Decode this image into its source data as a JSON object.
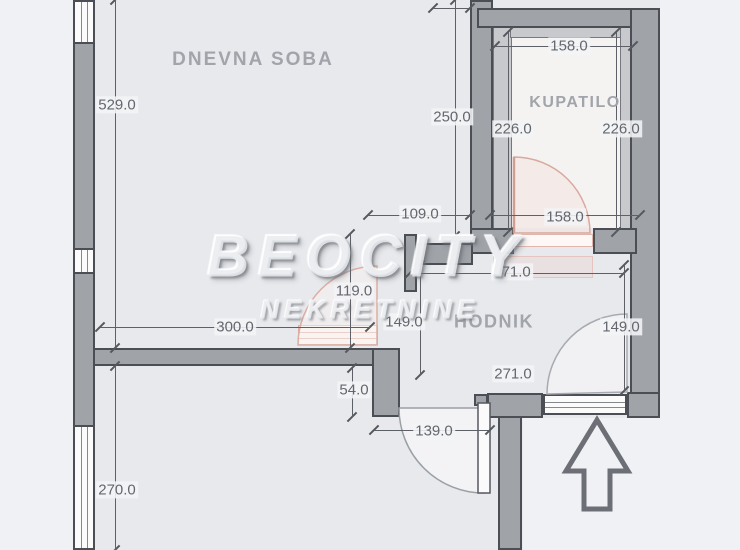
{
  "watermark": {
    "brand": "BEOCITY",
    "subtitle": "NEKRETNINE"
  },
  "rooms": [
    {
      "key": "dnevna-soba",
      "name": "DNEVNA SOBA",
      "x": 253,
      "y": 60
    },
    {
      "key": "kupatilo",
      "name": "KUPATILO",
      "x": 575,
      "y": 103
    },
    {
      "key": "hodnik",
      "name": "HODNIK",
      "x": 494,
      "y": 322
    }
  ],
  "dimensions": [
    {
      "name": "dim-529",
      "label": "529.0",
      "x": 117,
      "y": 105
    },
    {
      "name": "dim-270",
      "label": "270.0",
      "x": 117,
      "y": 490
    },
    {
      "name": "dim-250",
      "label": "250.0",
      "x": 452,
      "y": 117
    },
    {
      "name": "dim-226-left",
      "label": "226.0",
      "x": 513,
      "y": 129
    },
    {
      "name": "dim-226-right",
      "label": "226.0",
      "x": 621,
      "y": 129
    },
    {
      "name": "dim-158-top",
      "label": "158.0",
      "x": 569,
      "y": 46
    },
    {
      "name": "dim-158-bottom",
      "label": "158.0",
      "x": 565,
      "y": 217
    },
    {
      "name": "dim-109",
      "label": "109.0",
      "x": 420,
      "y": 214
    },
    {
      "name": "dim-271-top",
      "label": "271.0",
      "x": 512,
      "y": 272
    },
    {
      "name": "dim-119",
      "label": "119.0",
      "x": 354,
      "y": 291
    },
    {
      "name": "dim-149-left",
      "label": "149.0",
      "x": 404,
      "y": 322
    },
    {
      "name": "dim-149-right",
      "label": "149.0",
      "x": 621,
      "y": 327
    },
    {
      "name": "dim-300",
      "label": "300.0",
      "x": 235,
      "y": 327
    },
    {
      "name": "dim-54",
      "label": "54.0",
      "x": 354,
      "y": 390
    },
    {
      "name": "dim-271-bottom",
      "label": "271.0",
      "x": 513,
      "y": 374
    },
    {
      "name": "dim-139",
      "label": "139.0",
      "x": 434,
      "y": 431
    }
  ],
  "colors": {
    "wall_fill": "#a0a3a8",
    "wall_border": "#4b4e54",
    "lining_fill": "#c7c9cc",
    "window_fill": "#fbfbfc",
    "dimension_text": "#64676d",
    "room_label": "#a1a4aa",
    "door_pink": "#dcaea3",
    "arrow": "#6c6f75",
    "background": "#eff1f5",
    "interior": "#e8e9ec"
  },
  "geometry": {
    "zones": [
      {
        "name": "interior-main",
        "type": "interior",
        "x": 73,
        "y": 0,
        "w": 587,
        "h": 418
      },
      {
        "name": "interior-bottom",
        "type": "interior",
        "x": 73,
        "y": 348,
        "w": 450,
        "h": 202
      },
      {
        "name": "interior-bathroom",
        "type": "bath",
        "x": 512,
        "y": 38,
        "w": 108,
        "h": 190
      }
    ],
    "walls": [
      {
        "name": "left-window-top",
        "type": "window-v",
        "x": 73,
        "y": 0,
        "w": 22,
        "h": 44
      },
      {
        "name": "left-wall-upper",
        "type": "wall",
        "x": 73,
        "y": 42,
        "w": 22,
        "h": 208
      },
      {
        "name": "left-window-middle",
        "type": "window-v",
        "x": 73,
        "y": 248,
        "w": 22,
        "h": 26
      },
      {
        "name": "left-wall-lower",
        "type": "wall",
        "x": 73,
        "y": 272,
        "w": 22,
        "h": 155
      },
      {
        "name": "left-window-bottom",
        "type": "window-v",
        "x": 73,
        "y": 425,
        "w": 22,
        "h": 125
      },
      {
        "name": "center-vertical-wall",
        "type": "wall",
        "x": 470,
        "y": 0,
        "w": 23,
        "h": 244
      },
      {
        "name": "bathroom-top-wall",
        "type": "wall",
        "x": 477,
        "y": 8,
        "w": 183,
        "h": 20
      },
      {
        "name": "right-exterior-wall",
        "type": "wall",
        "x": 630,
        "y": 8,
        "w": 30,
        "h": 410
      },
      {
        "name": "bathroom-lining-left",
        "type": "lining",
        "x": 493,
        "y": 26,
        "w": 19,
        "h": 212
      },
      {
        "name": "bathroom-lining-top",
        "type": "lining",
        "x": 510,
        "y": 26,
        "w": 127,
        "h": 12
      },
      {
        "name": "bathroom-lining-right",
        "type": "lining",
        "x": 620,
        "y": 26,
        "w": 12,
        "h": 212
      },
      {
        "name": "bathroom-bottom-wall-left",
        "type": "wall",
        "x": 470,
        "y": 228,
        "w": 44,
        "h": 26
      },
      {
        "name": "bathroom-bottom-wall-right",
        "type": "wall",
        "x": 593,
        "y": 228,
        "w": 44,
        "h": 26
      },
      {
        "name": "hodnik-left-wall",
        "type": "wall",
        "x": 404,
        "y": 234,
        "w": 13,
        "h": 58
      },
      {
        "name": "hodnik-top-wall",
        "type": "wall",
        "x": 417,
        "y": 243,
        "w": 56,
        "h": 22
      },
      {
        "name": "middle-horizontal-wall",
        "type": "wall",
        "x": 93,
        "y": 348,
        "w": 281,
        "h": 18
      },
      {
        "name": "step-wall",
        "type": "wall",
        "x": 372,
        "y": 348,
        "w": 28,
        "h": 69
      },
      {
        "name": "entry-wall-cap",
        "type": "wall",
        "x": 487,
        "y": 393,
        "w": 56,
        "h": 25
      },
      {
        "name": "bottom-vertical-wall",
        "type": "wall",
        "x": 498,
        "y": 416,
        "w": 24,
        "h": 134
      },
      {
        "name": "entry-window",
        "type": "window-h",
        "x": 543,
        "y": 394,
        "w": 84,
        "h": 21
      },
      {
        "name": "bottom-wall-right-block",
        "type": "wall",
        "x": 627,
        "y": 392,
        "w": 33,
        "h": 26
      },
      {
        "name": "entry-door-hinge-block",
        "type": "wall",
        "x": 474,
        "y": 394,
        "w": 14,
        "h": 12
      },
      {
        "name": "bathroom-door-threshold",
        "type": "threshold",
        "x": 514,
        "y": 234,
        "w": 79,
        "h": 13
      },
      {
        "name": "renovation-pink-zone",
        "type": "pinkzone",
        "x": 493,
        "y": 256,
        "w": 100,
        "h": 22
      },
      {
        "name": "living-door-pocket",
        "type": "pocket",
        "x": 298,
        "y": 325,
        "w": 80,
        "h": 20
      }
    ],
    "dim_lines": [
      {
        "name": "dim-529-line",
        "o": "v",
        "x": 115,
        "y": 0,
        "len": 348
      },
      {
        "name": "dim-270-line",
        "o": "v",
        "x": 115,
        "y": 366,
        "len": 184
      },
      {
        "name": "dim-250-line",
        "o": "v",
        "x": 455,
        "y": 0,
        "len": 236
      },
      {
        "name": "dim-226-left-line",
        "o": "v",
        "x": 508,
        "y": 32,
        "len": 200
      },
      {
        "name": "dim-226-right-line",
        "o": "v",
        "x": 616,
        "y": 32,
        "len": 200
      },
      {
        "name": "dim-158-top-line",
        "o": "h",
        "x": 495,
        "y": 46,
        "len": 138
      },
      {
        "name": "dim-158-bottom-line",
        "o": "h",
        "x": 490,
        "y": 215,
        "len": 150
      },
      {
        "name": "dim-109-line",
        "o": "h",
        "x": 368,
        "y": 215,
        "len": 102
      },
      {
        "name": "dim-271-top-line",
        "o": "h",
        "x": 410,
        "y": 273,
        "len": 214
      },
      {
        "name": "dim-119-line",
        "o": "v",
        "x": 350,
        "y": 234,
        "len": 114
      },
      {
        "name": "dim-149-left-line",
        "o": "v",
        "x": 420,
        "y": 265,
        "len": 110
      },
      {
        "name": "dim-149-right-line",
        "o": "v",
        "x": 624,
        "y": 265,
        "len": 126
      },
      {
        "name": "dim-300-line",
        "o": "h",
        "x": 100,
        "y": 327,
        "len": 270
      },
      {
        "name": "dim-54-line",
        "o": "v",
        "x": 352,
        "y": 368,
        "len": 49
      },
      {
        "name": "dim-139-line",
        "o": "h",
        "x": 374,
        "y": 430,
        "len": 116
      },
      {
        "name": "dim-top-edge-line",
        "o": "h",
        "x": 433,
        "y": 8,
        "len": 37
      }
    ],
    "svg_paths": [
      {
        "name": "bathroom-door-arc",
        "d": "M514,233 L514,157 A76,76 0 0 1 590,233 Z",
        "stroke": "#d9a99e",
        "w": 1.5,
        "fill": "rgba(244,226,221,0.45)"
      },
      {
        "name": "bathroom-door-leaf",
        "d": "M514,157 L514,233",
        "stroke": "#cf9e94",
        "w": 2.5,
        "fill": "none"
      },
      {
        "name": "living-door-arc",
        "d": "M377,345 L298,345 A79,79 0 0 1 377,266 Z",
        "stroke": "#dcaea3",
        "w": 1.5,
        "fill": "rgba(248,241,239,0.5)"
      },
      {
        "name": "entry-door-arc",
        "d": "M484,408 L399,408 A85,85 0 0 0 484,493 Z",
        "stroke": "#9aa0a6",
        "w": 1.5,
        "fill": "rgba(250,250,251,0.6)"
      },
      {
        "name": "entry-door-leaf",
        "d": "M478,403 L490,403 L490,493 L478,493 Z",
        "stroke": "#565960",
        "w": 1.5,
        "fill": "#fbfbfc"
      },
      {
        "name": "hodnik-entrance-arc",
        "d": "M627,392 L547,394 A80,80 0 0 1 627,314 Z",
        "stroke": "#a7abb0",
        "w": 1.5,
        "fill": "rgba(249,250,251,0.5)"
      },
      {
        "name": "north-arrow",
        "d": "M597,420 L628,471 L610,471 L610,509 L584,509 L584,471 L566,471 Z",
        "stroke": "#6c6f75",
        "w": 5,
        "fill": "none"
      }
    ]
  }
}
